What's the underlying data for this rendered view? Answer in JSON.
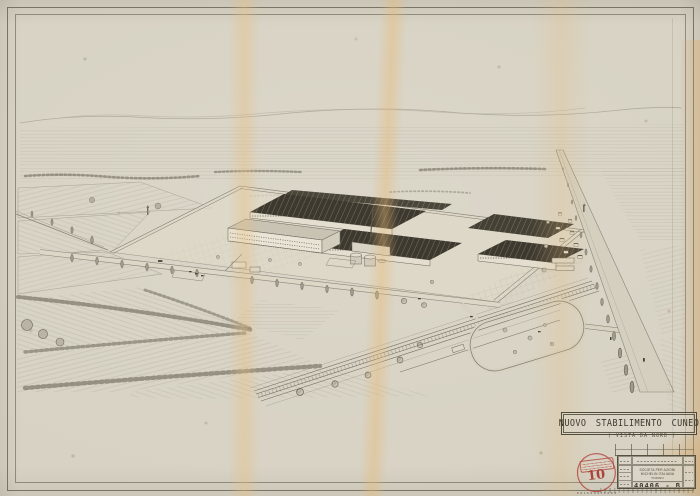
{
  "sheet": {
    "title": "NUOVO STABILIMENTO CUNEO",
    "subtitle": "( VISTA DA NORD )"
  },
  "title_block": {
    "company_line1": "SOCIETA PER AZIONI MICHELIN ITALIANA",
    "company_line2": "TORINO",
    "drawing_number": "40406 - B",
    "stamp_number": "10"
  },
  "scene": {
    "description": "aerial-perspective-pencil-drawing-of-factory-complex-in-farmland-seen-from-north"
  },
  "colors": {
    "paper": "#d7d2c3",
    "ink": "#55503f",
    "roof_dark": "#3d392f",
    "stain_orange": "#e8c48d",
    "stamp_red": "#ae362e",
    "frame": "#585344"
  }
}
